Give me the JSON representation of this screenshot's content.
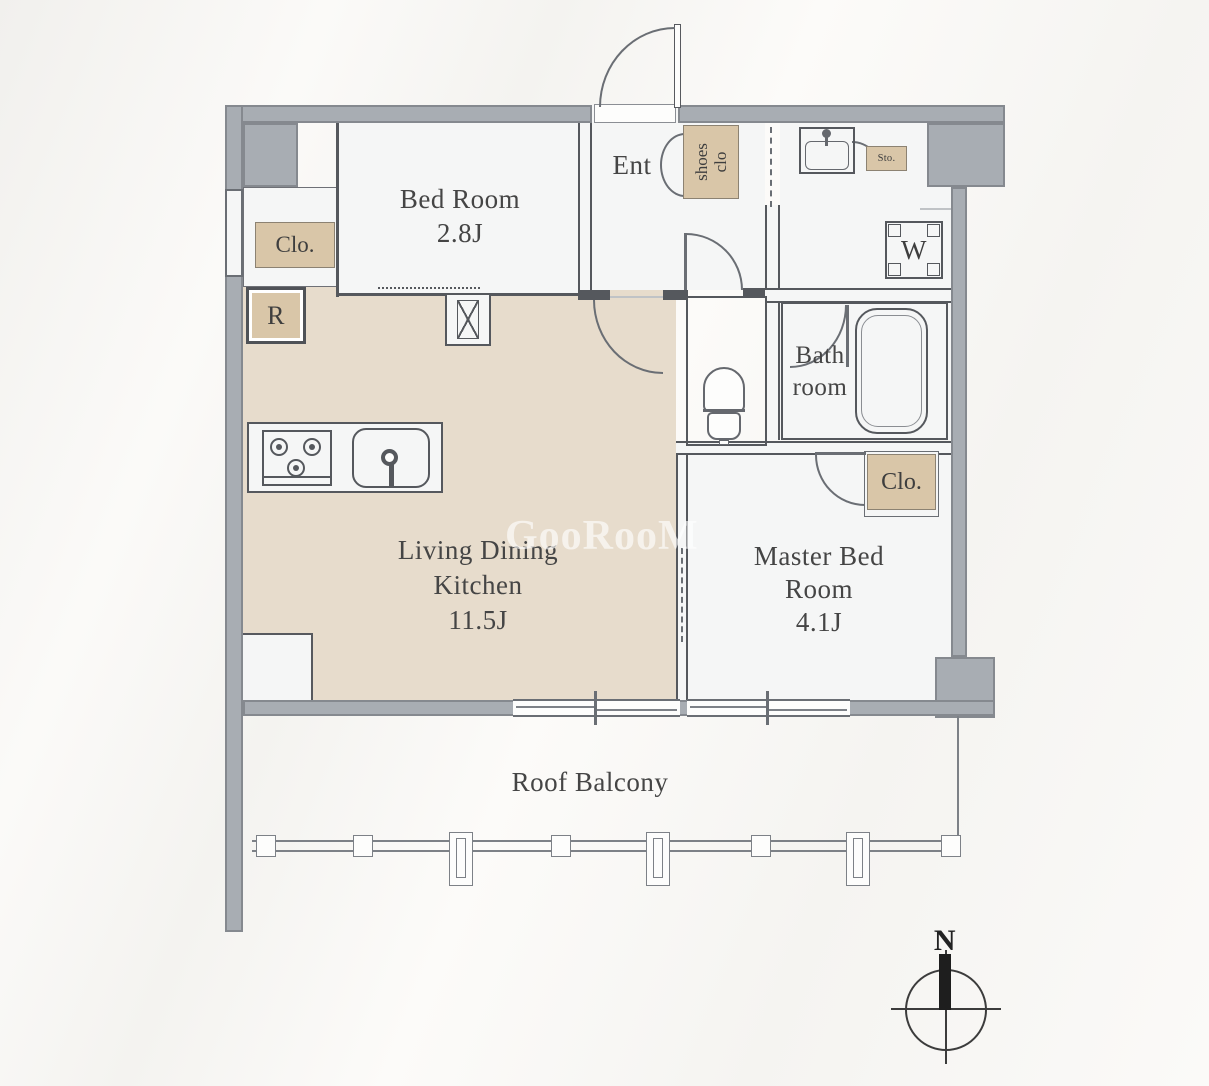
{
  "rooms": {
    "bedroom": {
      "name": "Bed Room",
      "size": "2.8J"
    },
    "ldk": {
      "line1": "Living Dining",
      "line2": "Kitchen",
      "size": "11.5J"
    },
    "master_bedroom": {
      "line1": "Master Bed",
      "line2": "Room",
      "size": "4.1J"
    },
    "bathroom": {
      "line1": "Bath",
      "line2": "room"
    },
    "entrance": {
      "label": "Ent"
    },
    "balcony": {
      "label": "Roof Balcony"
    }
  },
  "fixtures": {
    "closet_bedroom": "Clo.",
    "closet_master": "Clo.",
    "refrigerator": "R",
    "washer": "W",
    "storage": "Sto.",
    "shoes_closet": {
      "line1": "shoes",
      "line2": "clo"
    }
  },
  "compass": {
    "north": "N"
  },
  "watermark": "GooRooM",
  "colors": {
    "wall": "#a8adb3",
    "wall_edge": "#85898f",
    "ldk_floor": "#e7dccc",
    "closet_fill": "#d9c6a8",
    "room_fill": "#f5f6f6",
    "line": "#55585d"
  }
}
